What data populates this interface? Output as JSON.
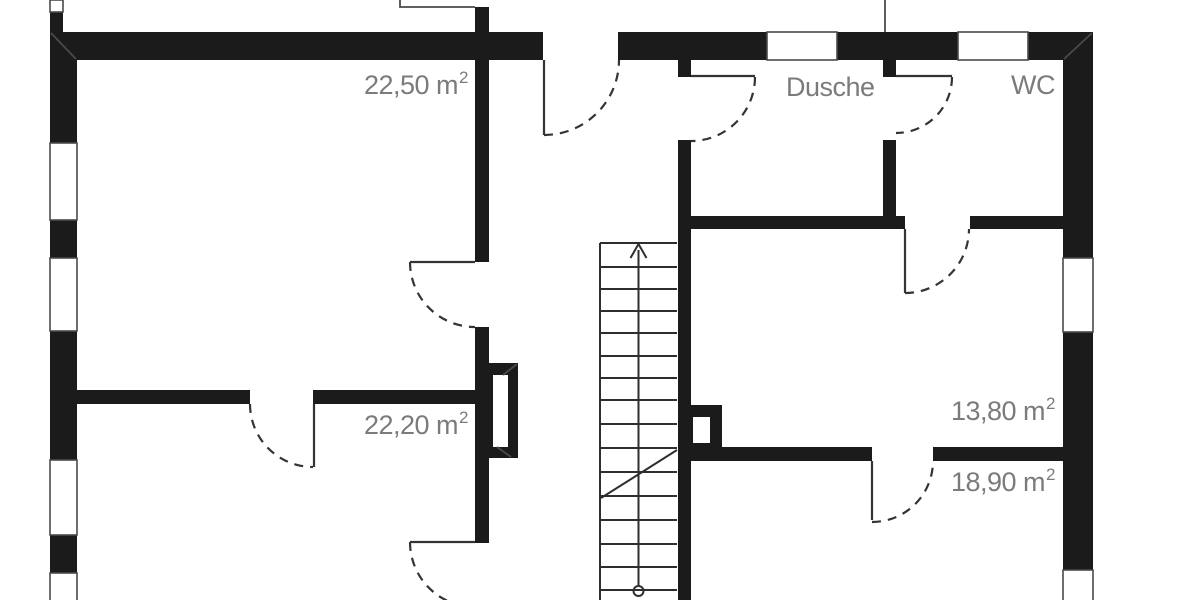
{
  "plan": {
    "colors": {
      "wall": "#1b1b1b",
      "door_line": "#343434",
      "label": "#7b7b7b",
      "background": "#ffffff"
    },
    "rooms": [
      {
        "name": "room-top-left",
        "text": "22,50 m",
        "sup": "2"
      },
      {
        "name": "shower-room",
        "text": "Dusche",
        "sup": ""
      },
      {
        "name": "wc-room",
        "text": "WC",
        "sup": ""
      },
      {
        "name": "room-bottom-left",
        "text": "22,20 m",
        "sup": "2"
      },
      {
        "name": "room-mid-right",
        "text": "13,80 m",
        "sup": "2"
      },
      {
        "name": "room-bottom-right",
        "text": "18,90 m",
        "sup": "2"
      }
    ]
  }
}
